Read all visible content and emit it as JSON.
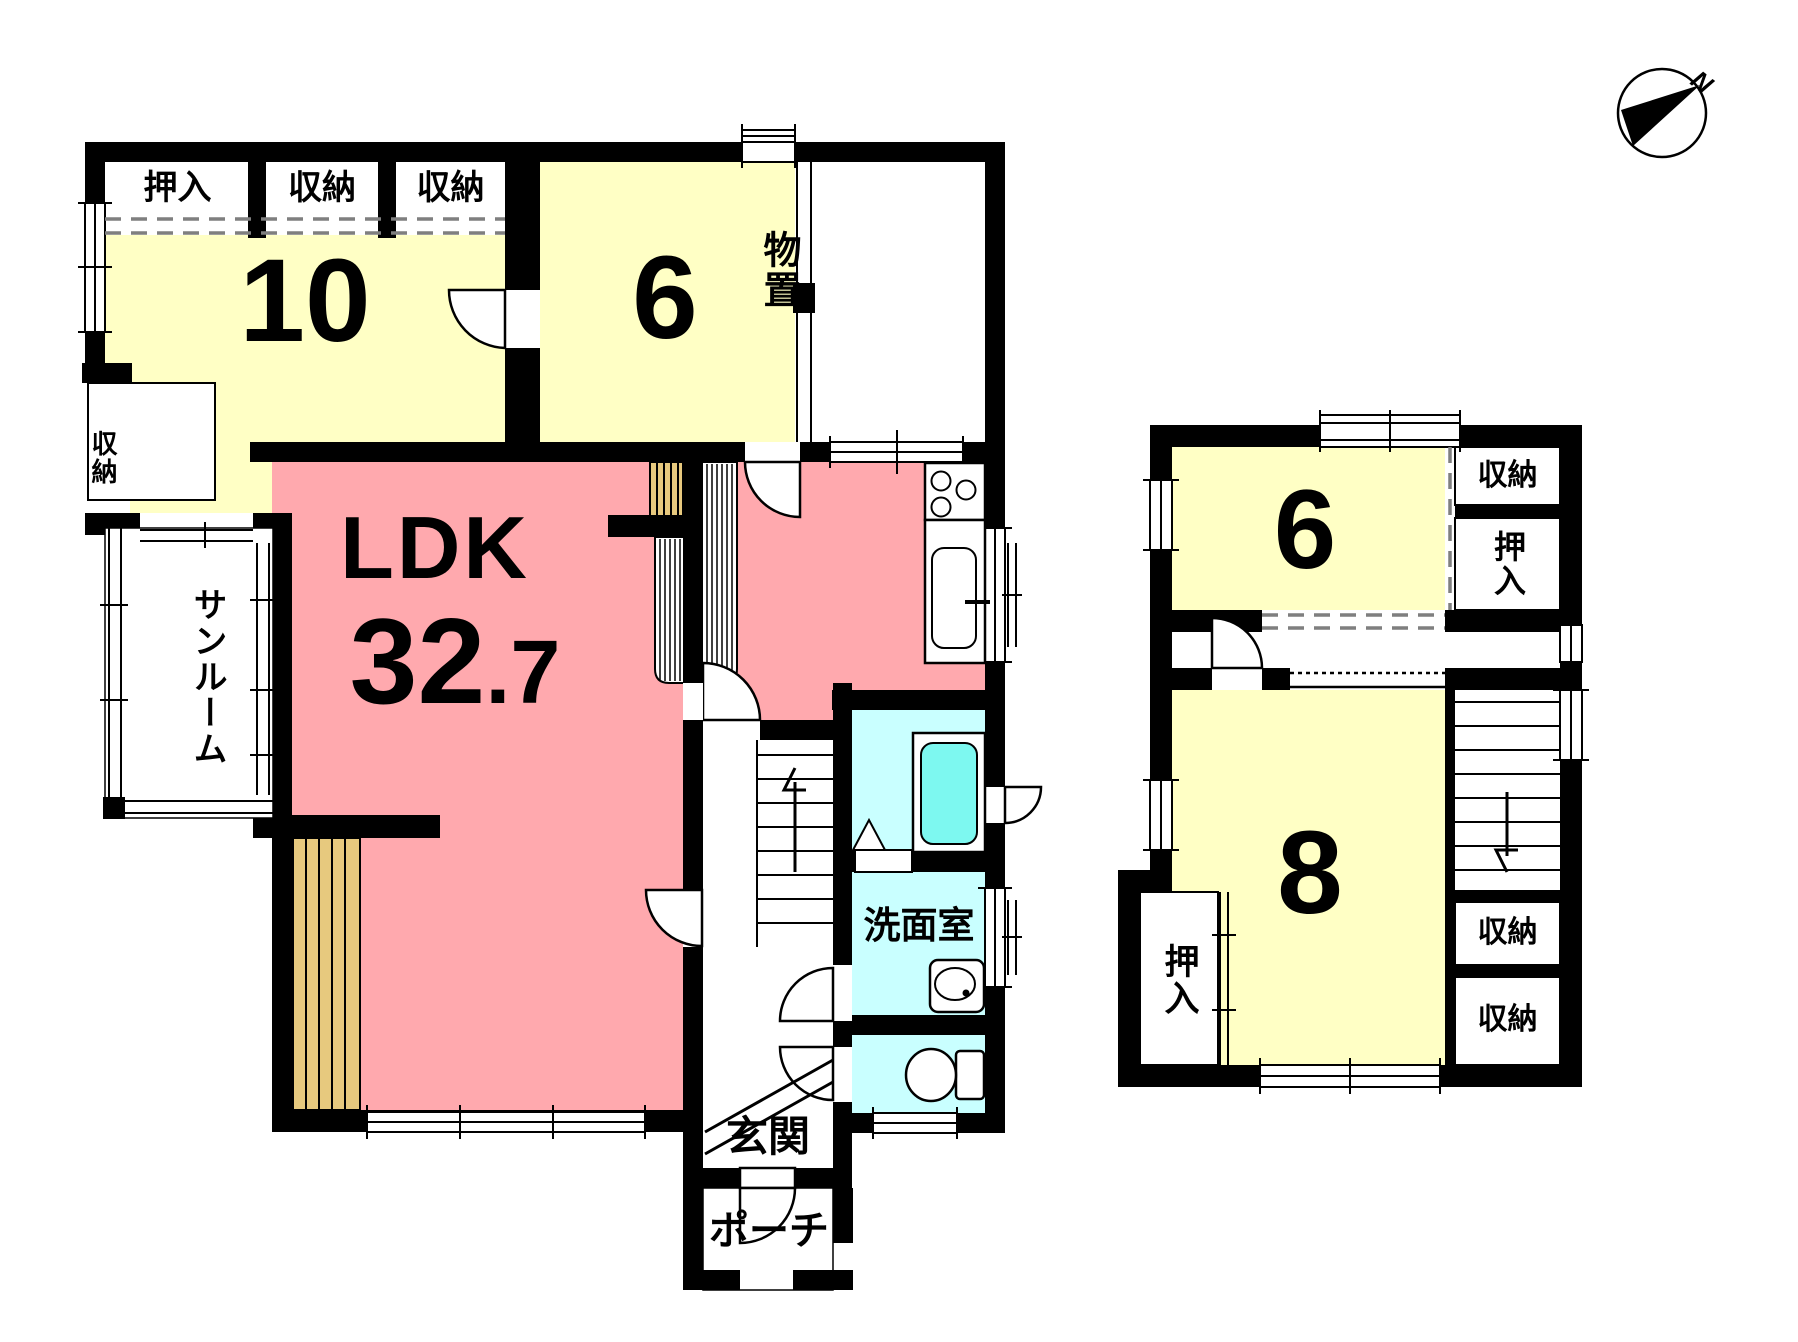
{
  "floor1": {
    "closet_top_oshiire": "押入",
    "closet_top_shuno_a": "収納",
    "closet_top_shuno_b": "収納",
    "closet_west_shuno": "収納",
    "room10_size": "10",
    "room6_size": "6",
    "storage_room": "物置",
    "sunroom": "サンルーム",
    "ldk_name": "LDK",
    "ldk_area_int": "32",
    "ldk_area_dec": ".7",
    "washroom": "洗面室",
    "entrance": "玄関",
    "porch": "ポーチ"
  },
  "floor2": {
    "room6_size": "6",
    "closet_right_top": "収納",
    "oshiire_right": "押入",
    "room8_size": "8",
    "closet_right_mid": "収納",
    "closet_right_bot": "収納",
    "oshiire_left": "押入"
  },
  "compass": {
    "north": "N"
  },
  "colors": {
    "wall": "#000000",
    "room_yellow": "#FFFFC5",
    "room_pink": "#FFA9AE",
    "room_cyan": "#C9FFFF",
    "tub_aqua": "#7DF8F0",
    "wood_tan": "#E7C97E",
    "dash_gray": "#7F7F7F"
  }
}
